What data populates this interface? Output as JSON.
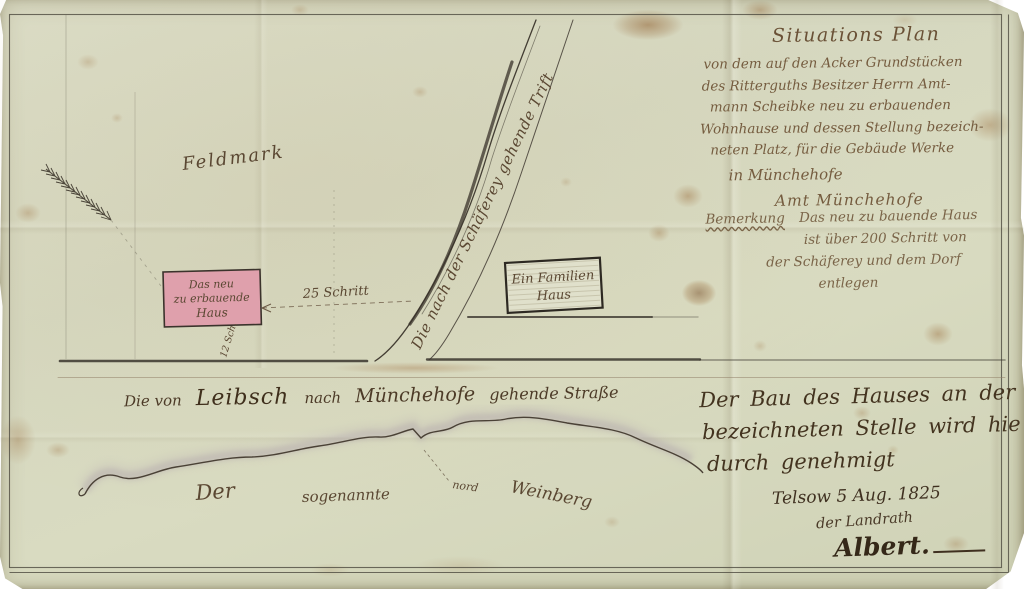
{
  "document_kind": "Handgezeichneter Situationsplan von 1825 (gealtertes Papier)",
  "colors": {
    "paper": "#d8dac3",
    "ink_dark": "#43331f",
    "ink_mid": "#6a5136",
    "ink_light": "#7a6448",
    "house_pink": "#dfa0ac",
    "hill_wash": "#a193a3",
    "stain_brown": "#925e2a"
  },
  "icons": {
    "north_arrow": "feathered-survey-arrow"
  },
  "title_block": {
    "lines": [
      "Situations Plan",
      "von dem auf den Acker Grundstücken",
      "des Ritterguths Besitzer Herrn Amt-",
      "mann Scheibke neu zu erbauenden",
      "Wohnhause und dessen Stellung bezeich-",
      "neten Platz, für die Gebäude Werke",
      "in Münchehofe",
      "Amt Münchehofe"
    ]
  },
  "note_block": {
    "heading": "Bemerkung",
    "lines": [
      "Das neu zu bauende Haus",
      "ist über 200 Schritt von",
      "der Schäferey und dem Dorf",
      "entlegen"
    ]
  },
  "approval_block": {
    "lines": [
      "Der Bau des Hauses an der",
      "bezeichneten Stelle wird hie",
      "durch genehmigt"
    ],
    "date": "Telsow 5 Aug. 1825",
    "official": "der Landrath",
    "signature": "Albert."
  },
  "map": {
    "field_label": "Feldmark",
    "trift_label": "Die nach der Schäferey gehende Trift",
    "distance_label": "25 Schritt",
    "side_distance_label": "12 Sch.",
    "new_house": {
      "lines": [
        "Das neu",
        "zu erbauende",
        "Haus"
      ]
    },
    "family_house": {
      "lines": [
        "Ein Familien",
        "Haus"
      ]
    },
    "street_label_parts": [
      "Die von",
      "Leibsch",
      "nach",
      "Münchehofe",
      "gehende Straße"
    ],
    "hill": {
      "article": "Der",
      "middle": "sogenannte",
      "name": "Weinberg",
      "direction": "nord"
    }
  }
}
